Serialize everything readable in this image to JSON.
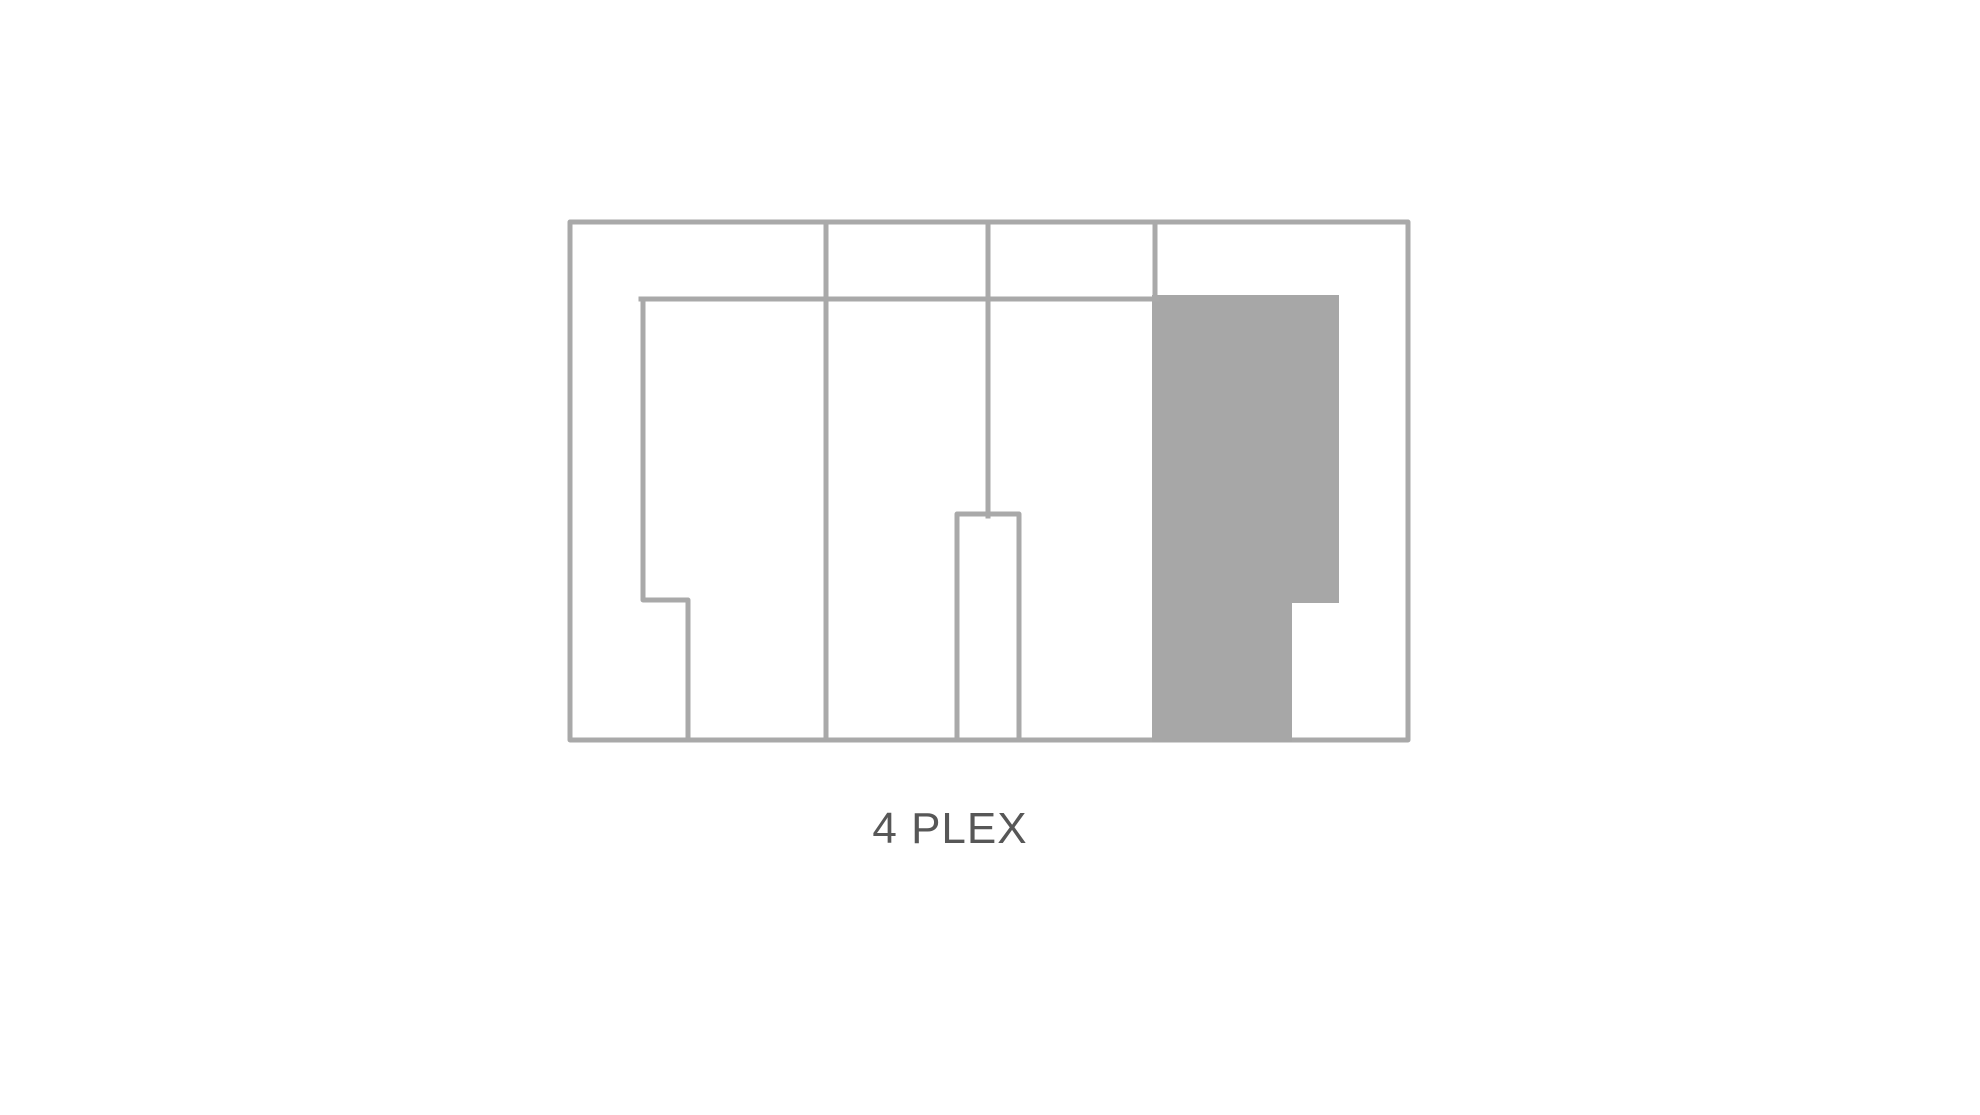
{
  "title": {
    "label": "4 PLEX"
  },
  "colors": {
    "background": "#ffffff",
    "line": "#a9a9a9",
    "fill": "#a7a7a7",
    "text": "#575757"
  },
  "floorplan": {
    "viewbox": "0 0 1980 1115",
    "stroke_width": 5,
    "shapes": [
      {
        "name": "outer-wall",
        "type": "rect",
        "x": 570,
        "y": 222,
        "width": 838,
        "height": 518,
        "filled": false
      },
      {
        "name": "shaded-unit",
        "type": "polygon",
        "filled": true,
        "points": [
          [
            1152,
            295
          ],
          [
            1339,
            295
          ],
          [
            1339,
            603
          ],
          [
            1292,
            603
          ],
          [
            1292,
            742
          ],
          [
            1152,
            742
          ]
        ]
      },
      {
        "name": "inner-ceiling-wall",
        "type": "line",
        "x1": 641,
        "y1": 299,
        "x2": 1157,
        "y2": 299
      },
      {
        "name": "unit-divider-1",
        "type": "line",
        "x1": 826,
        "y1": 222,
        "x2": 826,
        "y2": 740
      },
      {
        "name": "unit-divider-2",
        "type": "line",
        "x1": 988,
        "y1": 222,
        "x2": 988,
        "y2": 516
      },
      {
        "name": "unit-divider-3",
        "type": "line",
        "x1": 1155,
        "y1": 222,
        "x2": 1155,
        "y2": 299
      },
      {
        "name": "unit1-inner-wall",
        "type": "polyline",
        "filled": false,
        "points": [
          [
            643,
            299
          ],
          [
            643,
            600
          ],
          [
            688,
            600
          ],
          [
            688,
            740
          ]
        ]
      },
      {
        "name": "center-shaft-wall",
        "type": "polyline",
        "filled": false,
        "points": [
          [
            957,
            740
          ],
          [
            957,
            514
          ],
          [
            1019,
            514
          ],
          [
            1019,
            740
          ]
        ]
      }
    ]
  }
}
